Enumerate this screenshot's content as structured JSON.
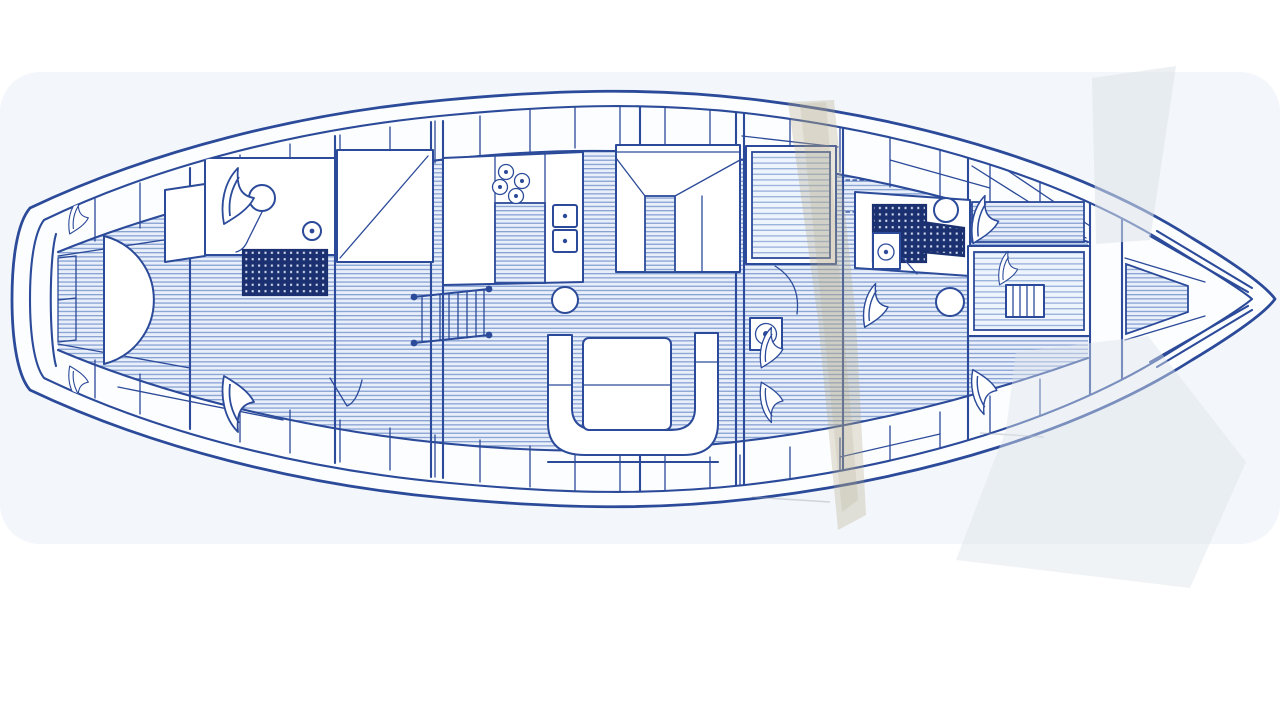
{
  "meta": {
    "description": "Scanned blueprint-style top-view interior deck plan of a sailing yacht, bow pointing right, drawn in navy blue ink on faded paper with scanner streak artifacts",
    "diagram_type": "yacht-interior-deck-plan",
    "visible_text": ""
  },
  "colors": {
    "paper": "#ffffff",
    "wash": "#f3f6fa",
    "interior": "#fcfdff",
    "furniture": "#ffffff",
    "line": "#2b4a99",
    "line-dark": "#1b3070",
    "sole-bg": "#e8effa",
    "sole-stripe": "#87a1d2",
    "mat-bg": "#eef4fc",
    "mat-stripe": "#9db4dd",
    "grate-bg": "#1b3070",
    "grate-dot": "#e8eefc",
    "tan": "#b3a888",
    "shadow": "#dde4ea",
    "pencil": "#9aa3ad"
  },
  "features": {
    "rooms": [
      {
        "name": "stern-cabin",
        "contains": [
          "curved-berth",
          "transom-lockers",
          "stowed-sails"
        ]
      },
      {
        "name": "aft-head",
        "contains": [
          "toilet",
          "sink",
          "shower-grating"
        ]
      },
      {
        "name": "wardrobe"
      },
      {
        "name": "galley",
        "contains": [
          "stove-burners",
          "double-sink",
          "counter",
          "pedestal"
        ]
      },
      {
        "name": "companionway-ladder"
      },
      {
        "name": "dinette"
      },
      {
        "name": "salon",
        "contains": [
          "u-settee",
          "table"
        ]
      },
      {
        "name": "mid-cabin",
        "contains": [
          "berth",
          "instrument"
        ]
      },
      {
        "name": "forward-head",
        "contains": [
          "toilet",
          "sink",
          "shower-grating"
        ]
      },
      {
        "name": "forward-cabin",
        "contains": [
          "berths",
          "steps"
        ]
      },
      {
        "name": "forepeak",
        "contains": [
          "chain-locker",
          "v-braces"
        ]
      }
    ],
    "artifacts": [
      "tan-scanner-streak",
      "gray-shadow-wedge-top",
      "gray-shadow-wedge-bottom"
    ]
  }
}
